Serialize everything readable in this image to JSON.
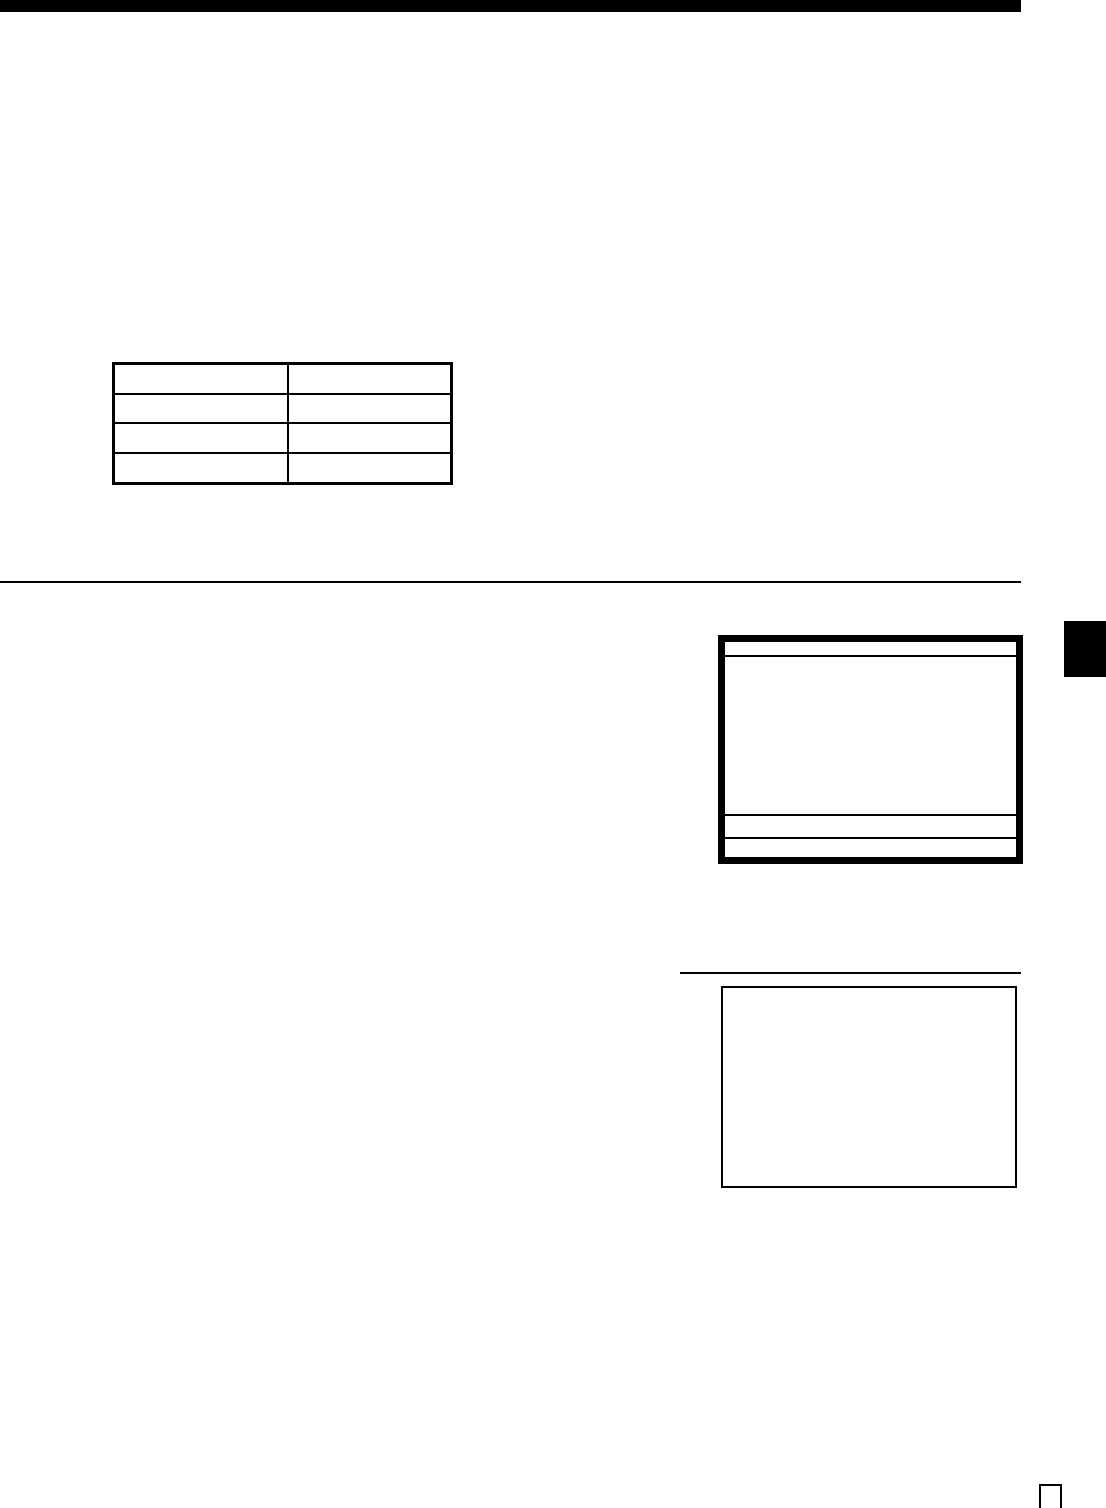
{
  "page": {
    "background_color": "#ffffff",
    "ink_color": "#000000"
  },
  "top_bar": {
    "color": "#000000"
  },
  "blank_table": {
    "rows": 4,
    "columns": 2,
    "cells": [
      [
        "",
        ""
      ],
      [
        "",
        ""
      ],
      [
        "",
        ""
      ],
      [
        "",
        ""
      ]
    ]
  },
  "screen_box": {
    "header_text": "",
    "body_text": "",
    "footer_row_1_text": "",
    "footer_row_2_text": ""
  },
  "chapter_tab": {
    "label": "",
    "color": "#000000"
  },
  "note_box": {
    "text": ""
  },
  "page_number_box": {
    "label": ""
  }
}
